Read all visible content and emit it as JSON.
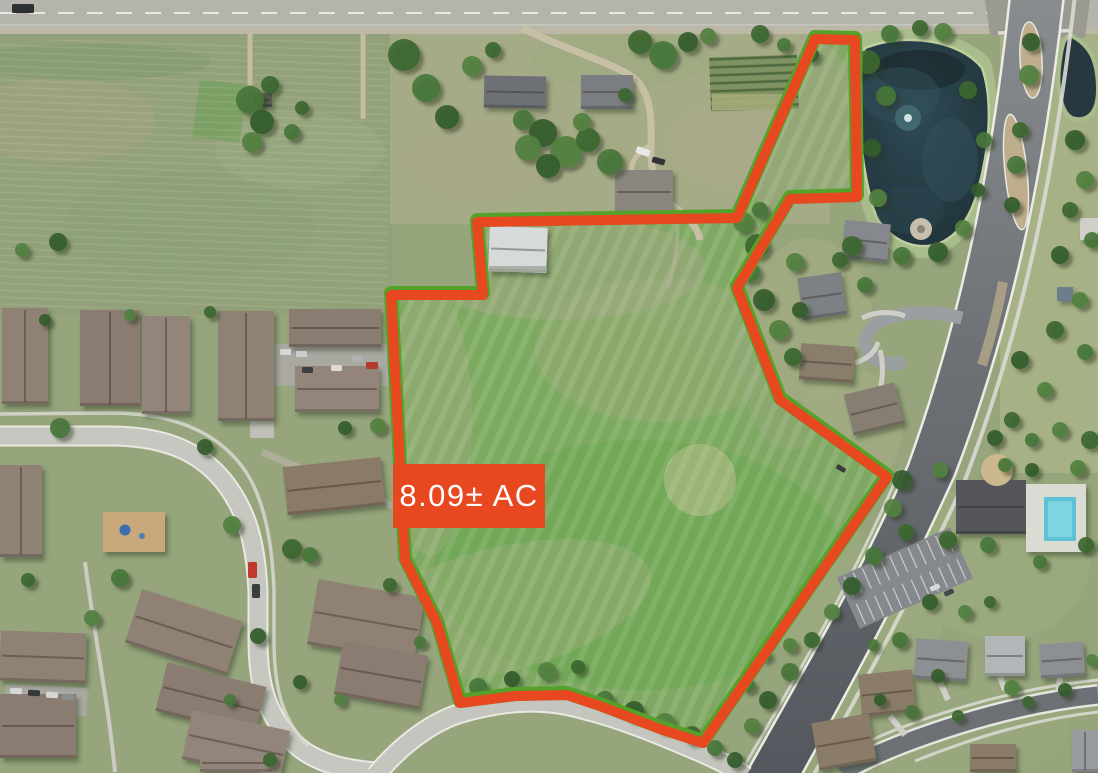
{
  "page": {
    "title": "Aerial property map"
  },
  "parcel": {
    "area_label": "8.09± AC",
    "boundary_color": "#e8481f",
    "survey_line_color": "#55a22b",
    "label_bg": "#e8481f",
    "label_text_color": "#ffffff",
    "label_box": {
      "x": 393,
      "y": 464,
      "w": 152,
      "h": 64
    },
    "boundary_points": [
      [
        477,
        222
      ],
      [
        737,
        218
      ],
      [
        815,
        39
      ],
      [
        855,
        40
      ],
      [
        857,
        197
      ],
      [
        790,
        199
      ],
      [
        737,
        288
      ],
      [
        780,
        400
      ],
      [
        887,
        477
      ],
      [
        703,
        743
      ],
      [
        660,
        729
      ],
      [
        600,
        706
      ],
      [
        567,
        695
      ],
      [
        515,
        696
      ],
      [
        460,
        703
      ],
      [
        437,
        623
      ],
      [
        405,
        560
      ],
      [
        391,
        295
      ],
      [
        483,
        295
      ]
    ]
  }
}
